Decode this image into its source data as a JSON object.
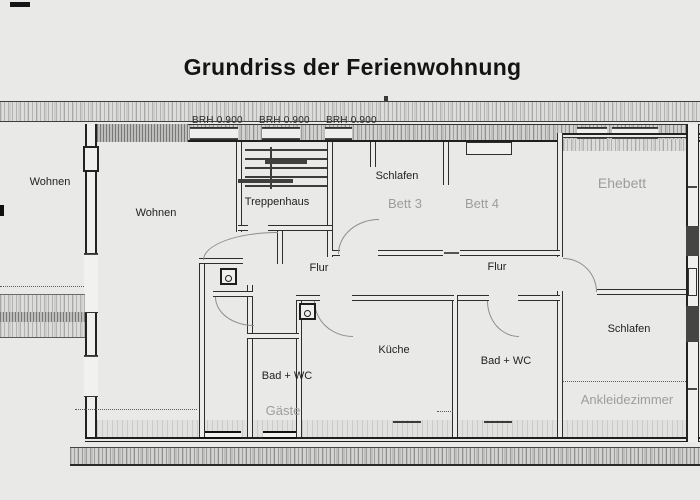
{
  "document": {
    "title": "Grundriss der Ferienwohnung"
  },
  "plan": {
    "window_sill_labels": [
      "BRH 0.900",
      "BRH 0.900",
      "BRH 0.900"
    ],
    "rooms": [
      {
        "name": "wohnen-left",
        "label": "Wohnen",
        "emphasis": "black"
      },
      {
        "name": "wohnen",
        "label": "Wohnen",
        "emphasis": "black"
      },
      {
        "name": "treppenhaus",
        "label": "Treppenhaus",
        "emphasis": "black"
      },
      {
        "name": "schlafen-kinder",
        "label": "Schlafen",
        "emphasis": "black"
      },
      {
        "name": "bett-3",
        "label": "Bett 3",
        "emphasis": "gray"
      },
      {
        "name": "bett-4",
        "label": "Bett 4",
        "emphasis": "gray"
      },
      {
        "name": "ehebett",
        "label": "Ehebett",
        "emphasis": "gray"
      },
      {
        "name": "flur-west",
        "label": "Flur",
        "emphasis": "black"
      },
      {
        "name": "flur-ost",
        "label": "Flur",
        "emphasis": "black"
      },
      {
        "name": "kueche",
        "label": "Küche",
        "emphasis": "black"
      },
      {
        "name": "bad-wc-west",
        "label": "Bad + WC",
        "emphasis": "black"
      },
      {
        "name": "gaeste",
        "label": "Gäste",
        "emphasis": "gray"
      },
      {
        "name": "bad-wc-ost",
        "label": "Bad + WC",
        "emphasis": "black"
      },
      {
        "name": "schlafen-sued",
        "label": "Schlafen",
        "emphasis": "black"
      },
      {
        "name": "ankleidezimmer",
        "label": "Ankleidezimmer",
        "emphasis": "gray"
      }
    ],
    "colors": {
      "paper": "#e9e9e7",
      "ink": "#222222",
      "gray_label": "#9d9d9b",
      "wall_hatch": "#b9b9b7"
    }
  }
}
